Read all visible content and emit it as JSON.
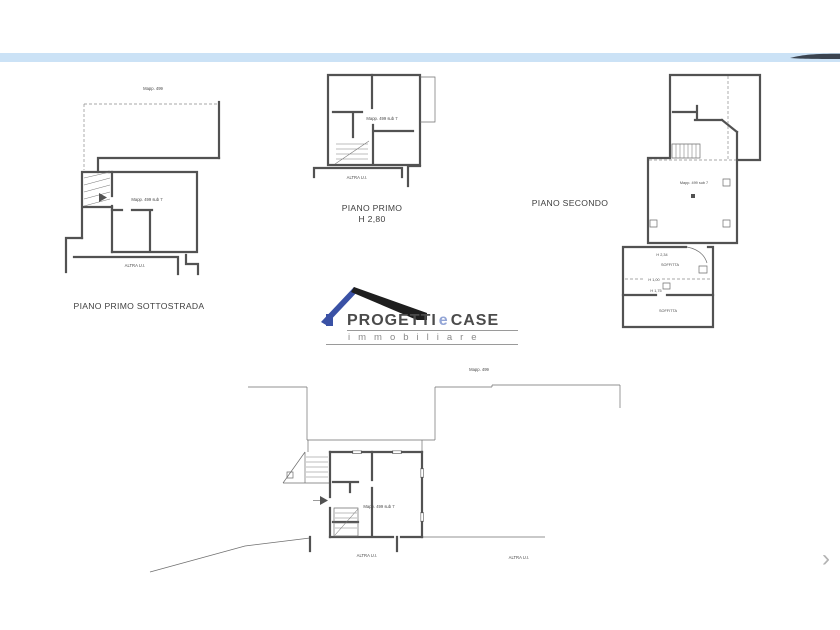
{
  "colors": {
    "top_bar": "#cbe2f6",
    "top_bar_swoosh": "#3b4450",
    "logo_blue": "#3a51a5",
    "logo_light_blue": "#93a5d6",
    "logo_roof_dark": "#1e1e1e",
    "drawing_line": "#525252",
    "text_dark": "#4a4a4a"
  },
  "plans": {
    "sottostrada": {
      "map_label": "Mapp. 499",
      "unit_label": "Mapp. 499 sub 7",
      "other_unit_label": "ALTRA U.I.",
      "title": "PIANO PRIMO SOTTOSTRADA"
    },
    "primo": {
      "unit_label": "Mapp. 499 sub 7",
      "other_unit_label": "ALTRA U.I.",
      "title": "PIANO PRIMO",
      "height_label": "H 2,80"
    },
    "secondo": {
      "title": "PIANO SECONDO",
      "unit_label": "Mapp. 499 sub 7",
      "h_upper": "H 2,34",
      "soffitta1": "SOFFITTA",
      "h_mid": "H 1,00",
      "h_lower": "H 1,75",
      "soffitta2": "SOFFITTA"
    },
    "terra": {
      "map_label": "Mapp. 499",
      "unit_label": "Mapp. 499 sub 7",
      "other_unit_label": "ALTRA U.I.",
      "other_unit_label_right": "ALTRA U.I."
    }
  },
  "logo": {
    "progetti": "PROGETTI",
    "e": "e",
    "case": "CASE",
    "sub": "immobiliare"
  },
  "carousel": {
    "next_icon": "›"
  }
}
